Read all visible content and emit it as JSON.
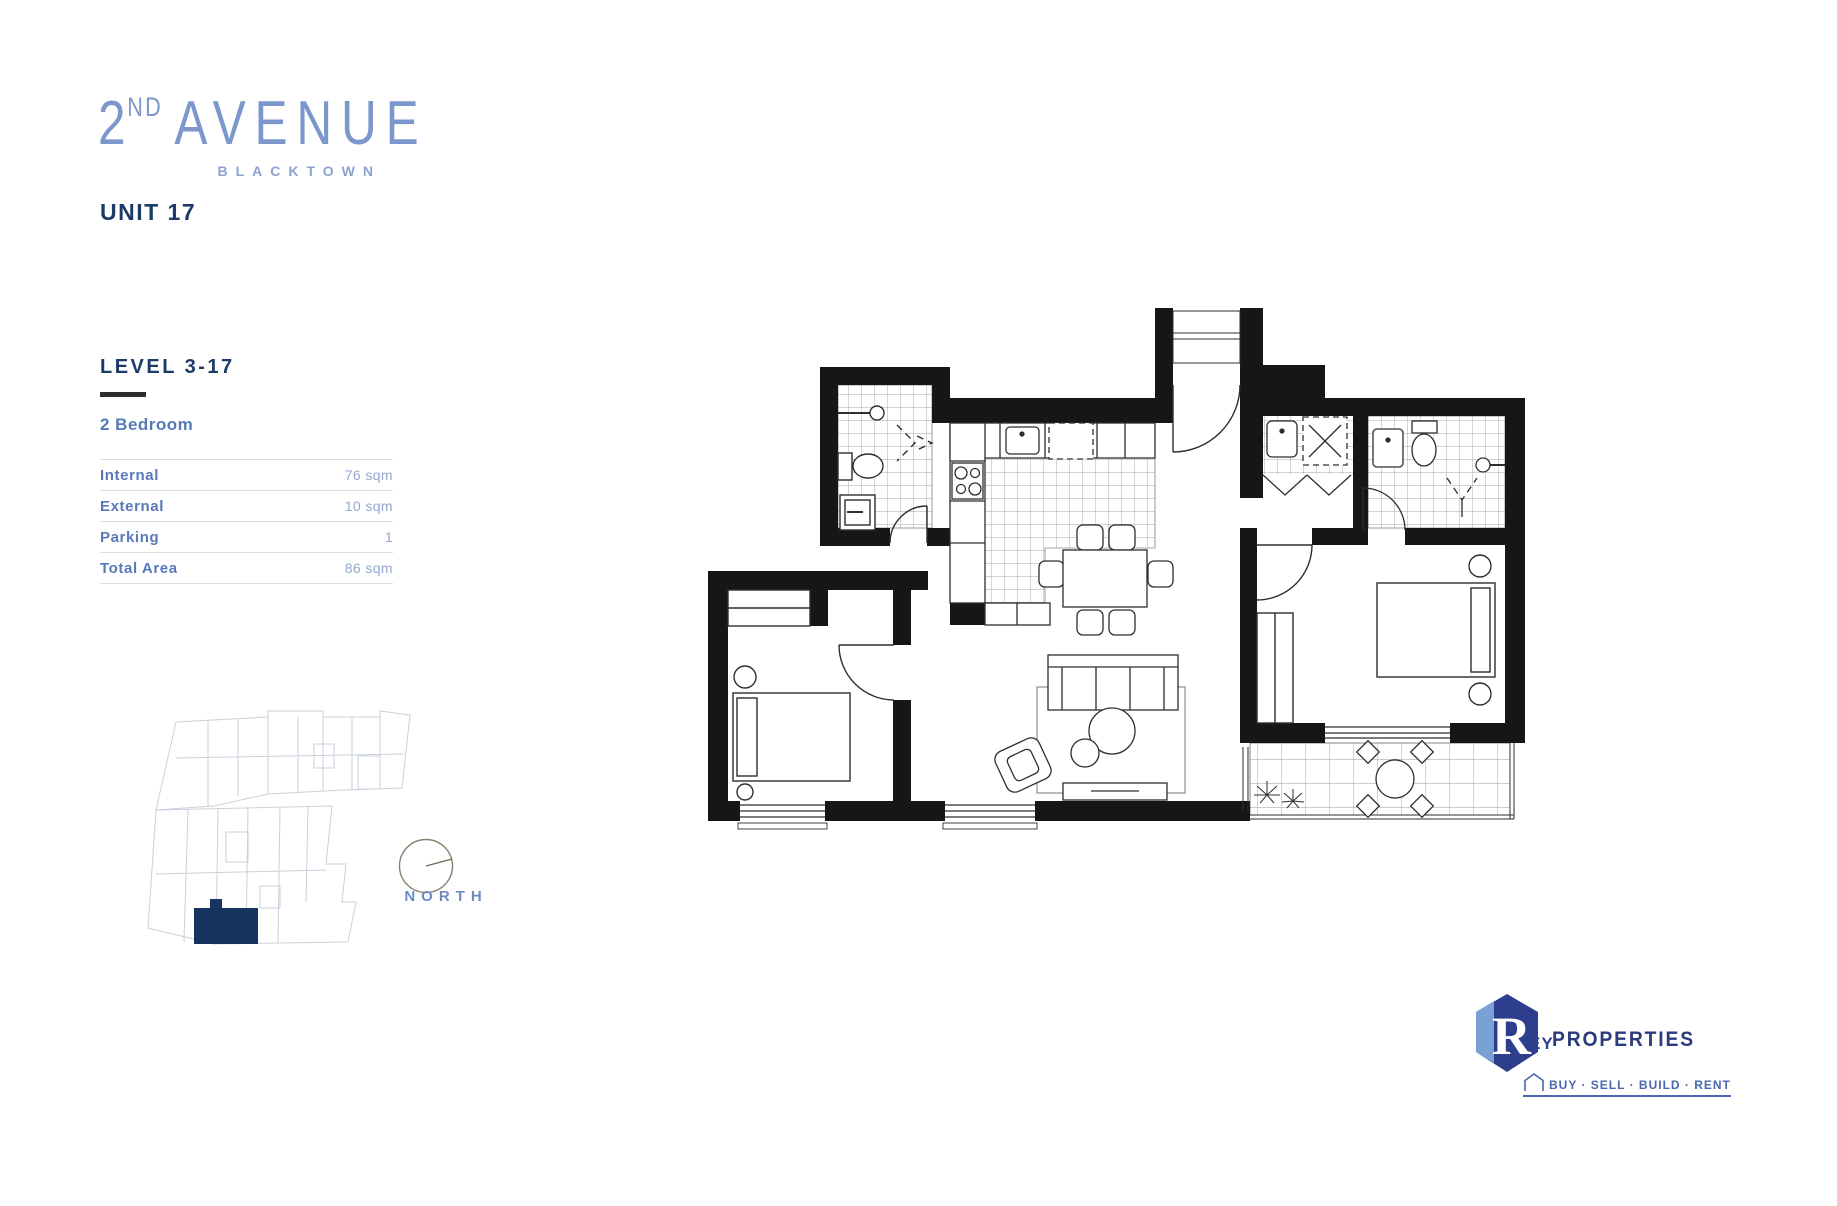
{
  "brand": {
    "number": "2",
    "ordinal": "ND",
    "name": "AVENUE",
    "location": "BLACKTOWN"
  },
  "unit": {
    "title": "UNIT 17",
    "level": "LEVEL 3-17",
    "type": "2 Bedroom"
  },
  "area_table": {
    "rows": [
      {
        "label": "Internal",
        "value": "76 sqm"
      },
      {
        "label": "External",
        "value": "10 sqm"
      },
      {
        "label": "Parking",
        "value": "1"
      },
      {
        "label": "Total Area",
        "value": "86 sqm"
      }
    ]
  },
  "keyplan": {
    "icon": "building-key-plan",
    "highlight_color": "#16355e",
    "line_color": "#c9d1dc"
  },
  "compass": {
    "icon": "compass-dial",
    "label": "NORTH"
  },
  "floorplan": {
    "icon": "floor-plan-drawing",
    "rooms": [
      "bathroom",
      "kitchen",
      "entry",
      "laundry",
      "ensuite",
      "master-bedroom",
      "second-bedroom",
      "living-dining",
      "balcony"
    ],
    "wall_color": "#161616"
  },
  "agency": {
    "initial": "R",
    "initial_suffix": "EY",
    "name": "PROPERTIES",
    "tagline": "BUY · SELL · BUILD · RENT",
    "color_dark": "#2d3e8c",
    "color_light": "#7ba0d6"
  },
  "colors": {
    "brand_blue": "#7b97cb",
    "navy": "#1d3b68",
    "label_blue": "#5878ba",
    "value_blue": "#94a7cf"
  }
}
